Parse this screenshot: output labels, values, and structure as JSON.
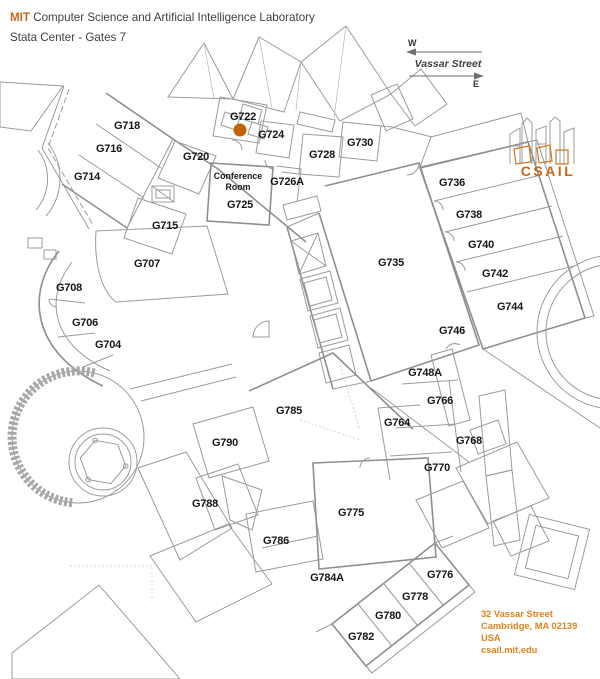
{
  "header": {
    "brand": "MIT",
    "title": " Computer Science and Artificial Intelligence Laboratory",
    "subtitle": "Stata Center - Gates 7"
  },
  "compass": {
    "west_label": "W",
    "east_label": "E",
    "street_label": "Vassar Street"
  },
  "logo": {
    "label": "CSAIL"
  },
  "address": {
    "lines": [
      "32 Vassar Street",
      "Cambridge, MA 02139",
      "USA",
      "csail.mit.edu"
    ]
  },
  "marker": {
    "room": "G722",
    "x": 240,
    "y": 130,
    "radius": 6.5,
    "color": "#c36400"
  },
  "conference_room": {
    "lines": [
      "Conference",
      "Room"
    ],
    "x": 238,
    "y": 176
  },
  "rooms": [
    {
      "label": "G718",
      "x": 127,
      "y": 125
    },
    {
      "label": "G716",
      "x": 109,
      "y": 148
    },
    {
      "label": "G714",
      "x": 87,
      "y": 176
    },
    {
      "label": "G720",
      "x": 196,
      "y": 156
    },
    {
      "label": "G722",
      "x": 243,
      "y": 116
    },
    {
      "label": "G724",
      "x": 271,
      "y": 134
    },
    {
      "label": "G726A",
      "x": 287,
      "y": 181
    },
    {
      "label": "G725",
      "x": 240,
      "y": 204
    },
    {
      "label": "G715",
      "x": 165,
      "y": 225
    },
    {
      "label": "G728",
      "x": 322,
      "y": 154
    },
    {
      "label": "G730",
      "x": 360,
      "y": 142
    },
    {
      "label": "G707",
      "x": 147,
      "y": 263
    },
    {
      "label": "G708",
      "x": 69,
      "y": 287
    },
    {
      "label": "G706",
      "x": 85,
      "y": 322
    },
    {
      "label": "G704",
      "x": 108,
      "y": 344
    },
    {
      "label": "G735",
      "x": 391,
      "y": 262
    },
    {
      "label": "G736",
      "x": 452,
      "y": 182
    },
    {
      "label": "G738",
      "x": 469,
      "y": 214
    },
    {
      "label": "G740",
      "x": 481,
      "y": 244
    },
    {
      "label": "G742",
      "x": 495,
      "y": 273
    },
    {
      "label": "G744",
      "x": 510,
      "y": 306
    },
    {
      "label": "G746",
      "x": 452,
      "y": 330
    },
    {
      "label": "G748A",
      "x": 425,
      "y": 372
    },
    {
      "label": "G766",
      "x": 440,
      "y": 400
    },
    {
      "label": "G764",
      "x": 397,
      "y": 422
    },
    {
      "label": "G768",
      "x": 469,
      "y": 440
    },
    {
      "label": "G770",
      "x": 437,
      "y": 467
    },
    {
      "label": "G785",
      "x": 289,
      "y": 410
    },
    {
      "label": "G790",
      "x": 225,
      "y": 442
    },
    {
      "label": "G788",
      "x": 205,
      "y": 503
    },
    {
      "label": "G786",
      "x": 276,
      "y": 540
    },
    {
      "label": "G775",
      "x": 351,
      "y": 512
    },
    {
      "label": "G784A",
      "x": 327,
      "y": 577
    },
    {
      "label": "G776",
      "x": 440,
      "y": 574
    },
    {
      "label": "G778",
      "x": 415,
      "y": 596
    },
    {
      "label": "G780",
      "x": 388,
      "y": 615
    },
    {
      "label": "G782",
      "x": 361,
      "y": 636
    }
  ],
  "colors": {
    "accent_orange": "#c8671b",
    "address_orange": "#e0811e",
    "marker_orange": "#c36400",
    "wall_gray": "#9b9b9b",
    "label_black": "#161616"
  }
}
